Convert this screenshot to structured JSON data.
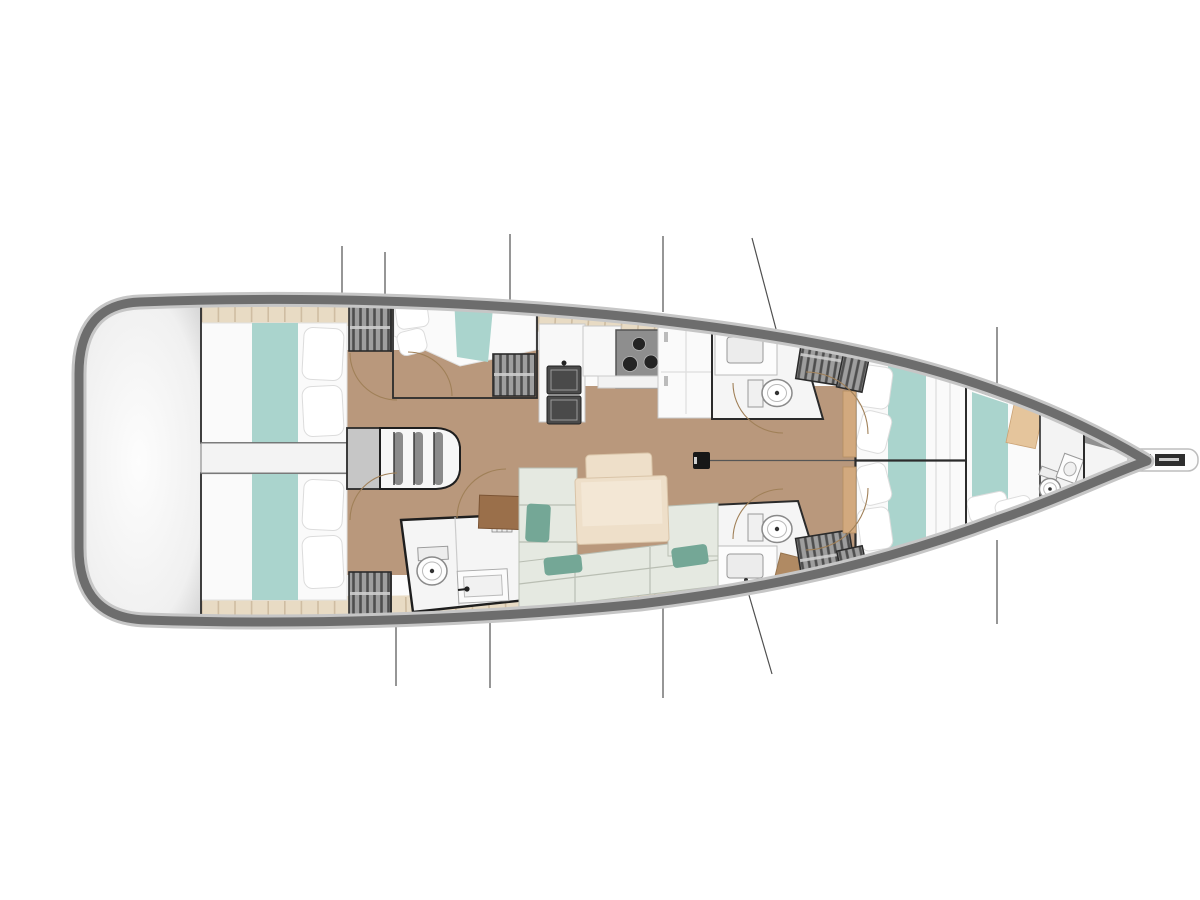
{
  "diagram": {
    "type": "sailboat-interior-floor-plan",
    "view": "top-down",
    "orientation": "bow-right",
    "text_labels": []
  },
  "colors": {
    "page_bg": "#ffffff",
    "hull_fill": "#fbfbfb",
    "hull_border": "#6d6d6d",
    "hull_halo": "#c6c6c6",
    "stern_fill": "#f0f0f0",
    "wood_floor": "#b9987c",
    "deck_plank": "#e8dbc4",
    "plank_tick": "#c9b69a",
    "bed_white": "#fafafa",
    "teal_runner": "#aad4cd",
    "sofa": "#e5e9e1",
    "sofa_line": "#b9beb3",
    "cushion_teal": "#74a796",
    "table_beige": "#eedfc9",
    "table_edge": "#d9c4a8",
    "nav_brown": "#9a6f4a",
    "tan_shelf": "#d2a97e",
    "locker_slat_bg": "#9e9e9e",
    "locker_slat": "#4e4e4e",
    "outline_dark": "#2b2b2b",
    "bath_floor": "#f5f5f5",
    "fixture_line": "#9a9a9a",
    "cooktop": "#8e8e8e",
    "burner": "#242424",
    "sink_dark": "#4a4a4a",
    "arc_brown": "#a08058",
    "line_gray": "#4f4f4f",
    "mast": "#171717"
  },
  "rooms": [
    {
      "id": "stern-platform",
      "label": "stern swim platform / transom"
    },
    {
      "id": "aft-cabin-top",
      "label": "aft double cabin, port"
    },
    {
      "id": "aft-cabin-bottom",
      "label": "aft double cabin, starboard"
    },
    {
      "id": "companionway",
      "label": "companionway stairs"
    },
    {
      "id": "mid-cabin-top",
      "label": "midship double cabin"
    },
    {
      "id": "galley",
      "label": "galley with double sink, cooktop, fridge"
    },
    {
      "id": "head-top",
      "label": "head with toilet, sink, hanging locker"
    },
    {
      "id": "head-bottom",
      "label": "head with toilet, sink, hanging locker"
    },
    {
      "id": "head-aft",
      "label": "aft head with toilet and sink"
    },
    {
      "id": "salon",
      "label": "salon with U-sofa, table and nav seat"
    },
    {
      "id": "vberth-cabin",
      "label": "forward V-berth cabin"
    },
    {
      "id": "bow-cabin",
      "label": "bow cabin with private head"
    },
    {
      "id": "bow-locker",
      "label": "anchor locker / bow tip"
    },
    {
      "id": "bowsprit",
      "label": "bowsprit with anchor roller"
    }
  ],
  "fixtures": {
    "double_beds": 6,
    "toilets": 4,
    "bathroom_sinks": 4,
    "galley_sink_basins": 2,
    "stove_burners": 3,
    "hanging_lockers": 7,
    "stair_treads": 4
  },
  "features": [
    "mast",
    "centerline",
    "door-swing-arcs",
    "bulkhead-station-lines",
    "deck-plank-band"
  ]
}
